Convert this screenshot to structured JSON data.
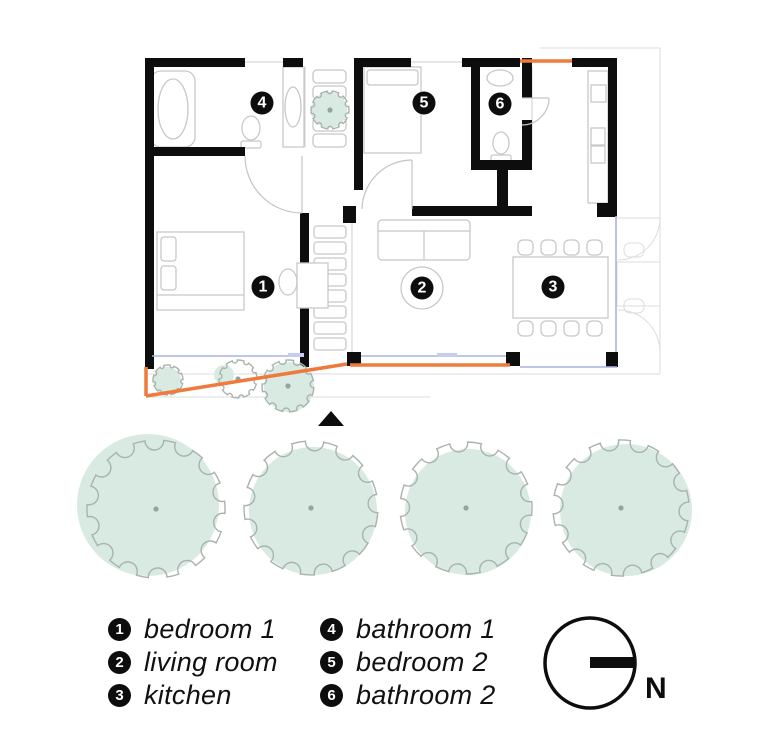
{
  "plan": {
    "room_markers": [
      "1",
      "2",
      "3",
      "4",
      "5",
      "6"
    ]
  },
  "legend": {
    "columns": [
      {
        "items": [
          {
            "num": "1",
            "label": "bedroom 1"
          },
          {
            "num": "2",
            "label": "living room"
          },
          {
            "num": "3",
            "label": "kitchen"
          }
        ]
      },
      {
        "items": [
          {
            "num": "4",
            "label": "bathroom 1"
          },
          {
            "num": "5",
            "label": "bedroom 2"
          },
          {
            "num": "6",
            "label": "bathroom 2"
          }
        ]
      }
    ]
  },
  "compass": {
    "label": "N"
  },
  "colors": {
    "wall": "#0d0d0d",
    "accent_orange": "#ee7b3c",
    "glazing_blue": "#a9b3e6",
    "tree_fill": "#d9eae2",
    "tree_outline": "#a9b3ae",
    "furniture_gray": "#c8c8c8"
  }
}
